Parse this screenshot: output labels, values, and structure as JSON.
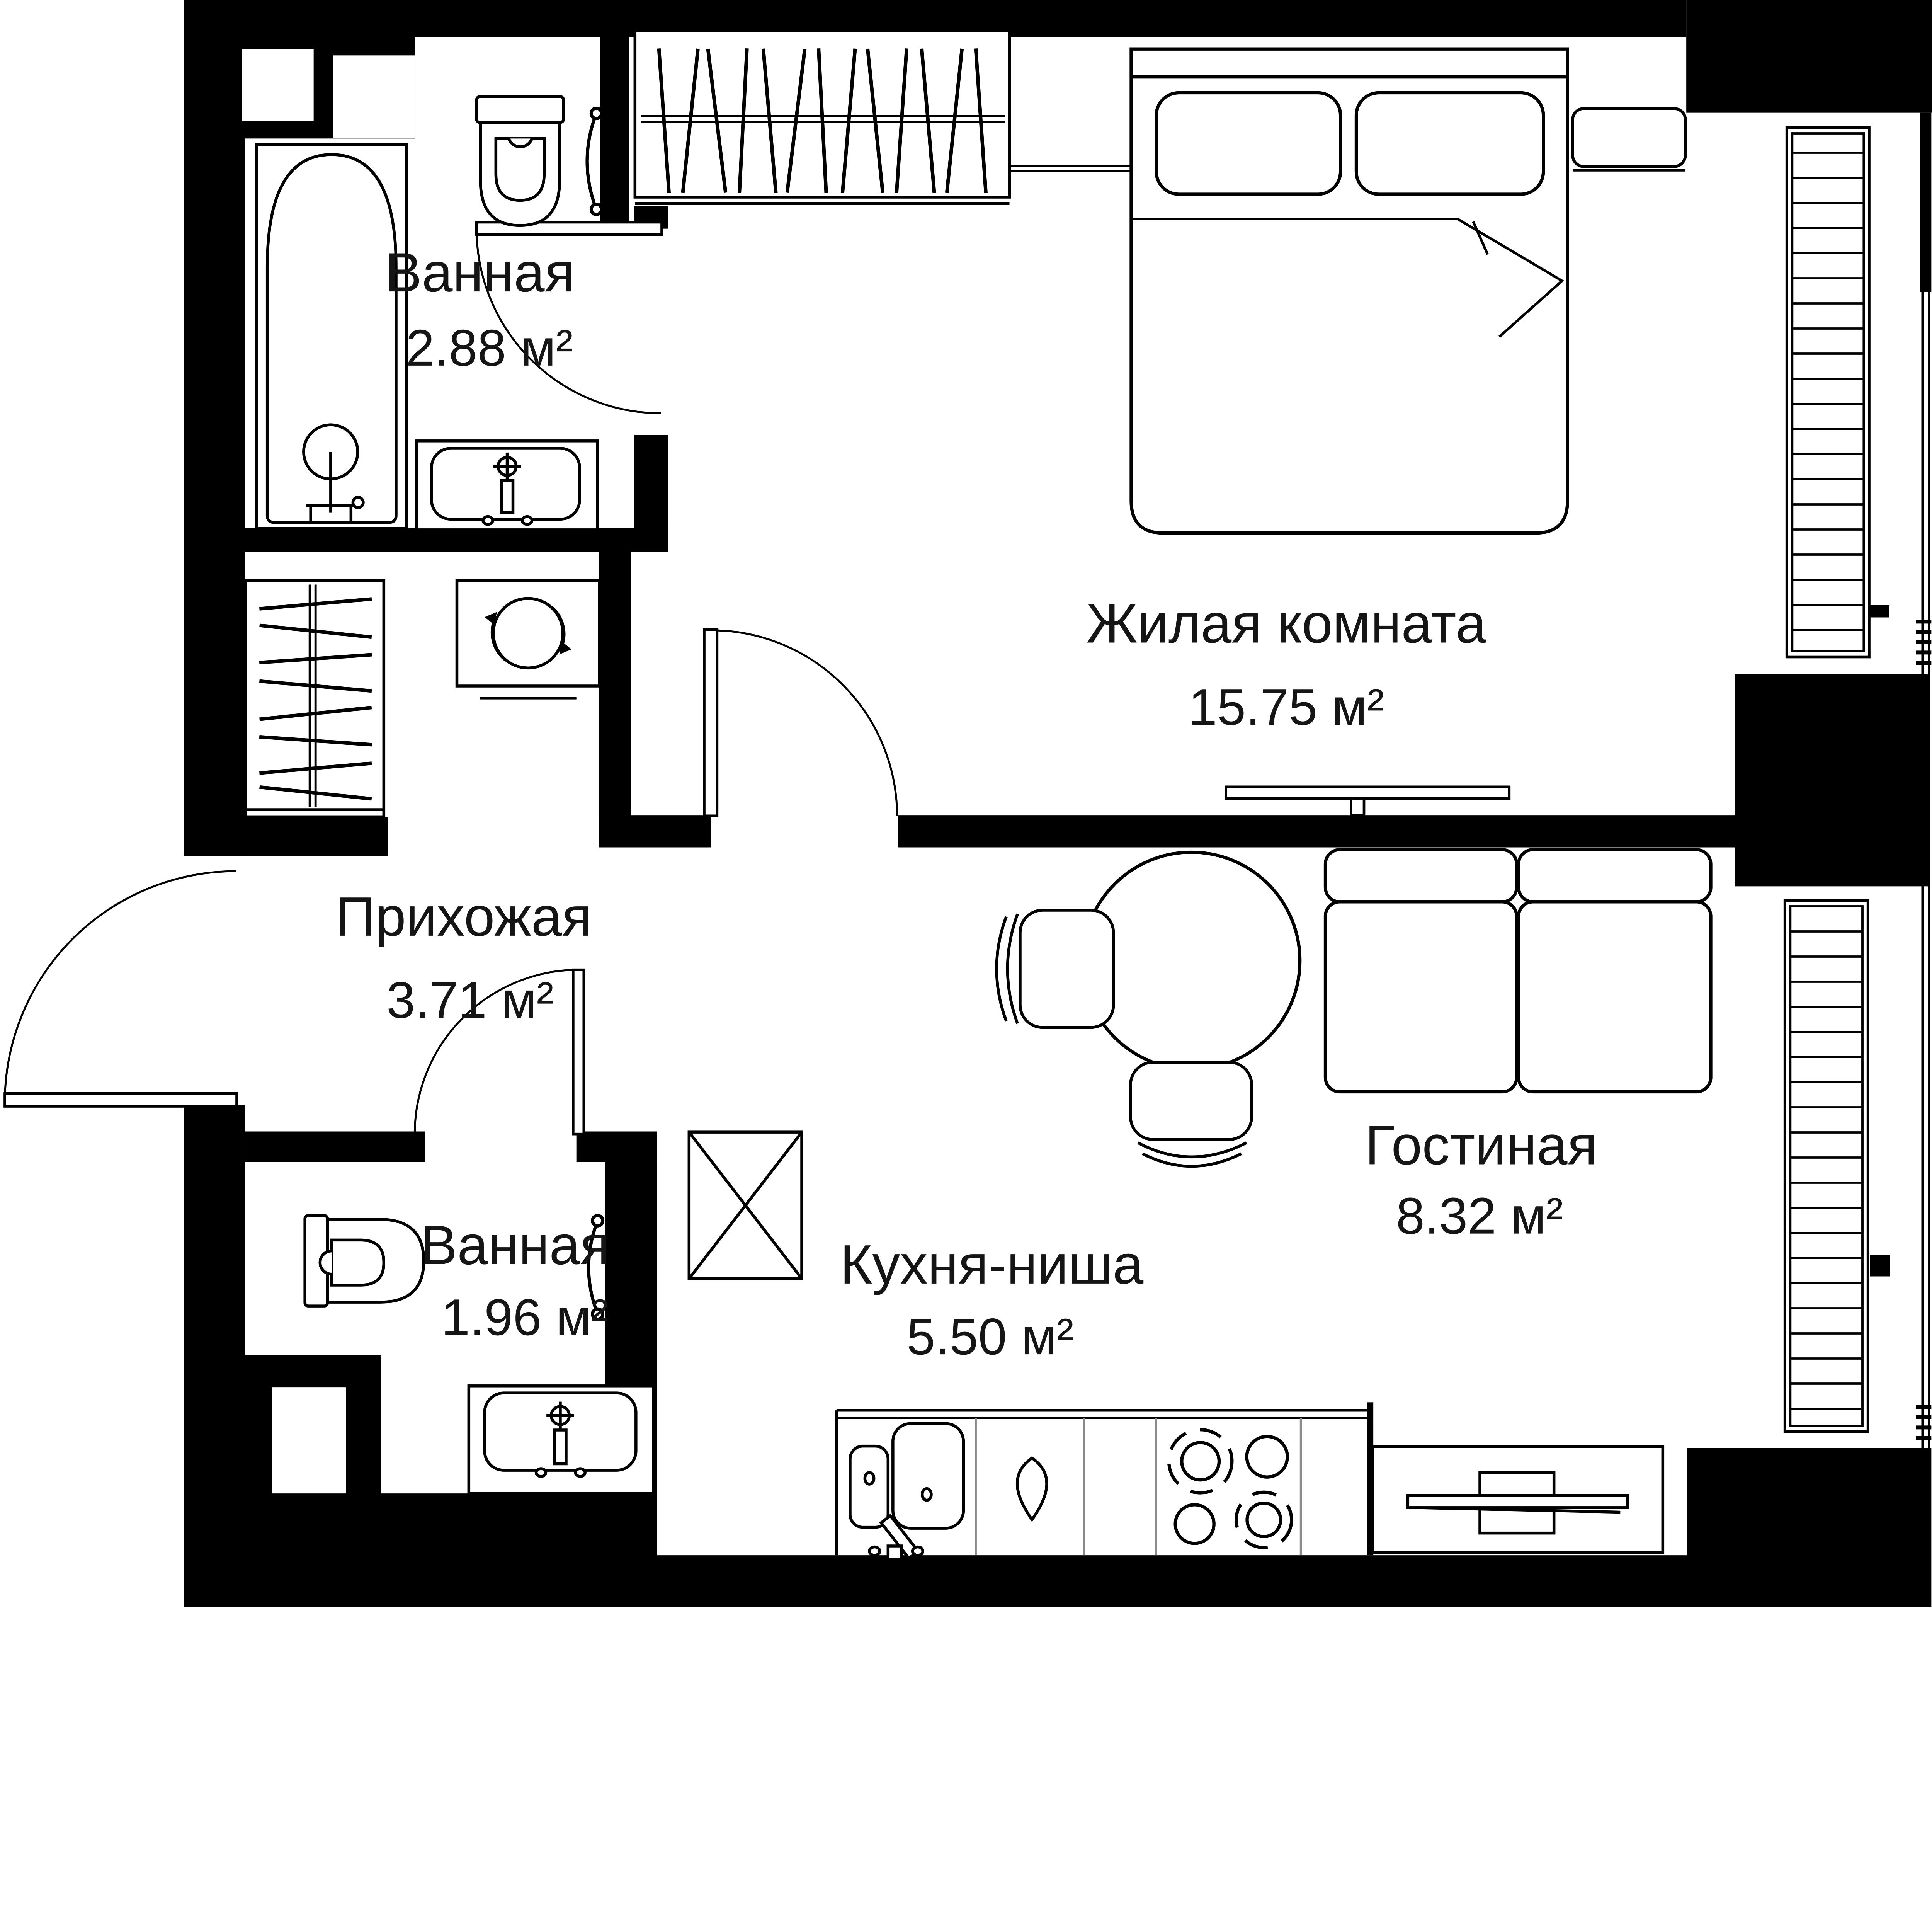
{
  "plan": {
    "type": "apartment-floor-plan",
    "style": "black-and-white architectural drawing",
    "area_unit": "м²"
  },
  "colors": {
    "walls": "#000000",
    "lines": "#000000",
    "counter_dividers": "#8a8a8a",
    "background": "#ffffff",
    "text": "#151515"
  },
  "rooms": [
    {
      "id": "bathroom-top",
      "name": "Ванная",
      "area": "2.88 м²"
    },
    {
      "id": "bedroom",
      "name": "Жилая комната",
      "area": "15.75 м²"
    },
    {
      "id": "hallway",
      "name": "Прихожая",
      "area": "3.71 м²"
    },
    {
      "id": "bathroom-low",
      "name": "Ванная",
      "area": "1.96 м²"
    },
    {
      "id": "kitchen-niche",
      "name": "Кухня-ниша",
      "area": "5.50 м²"
    },
    {
      "id": "lounge",
      "name": "Гостиная",
      "area": "8.32 м²"
    }
  ],
  "fixtures": [
    "bathtub",
    "toilet",
    "wall-sink",
    "towel-rail",
    "wardrobe-hangers",
    "hallway-closet-hangers",
    "washing-machine",
    "double-bed",
    "pillows",
    "nightstand",
    "wall-tv",
    "sofa-two-seat",
    "round-table",
    "chair",
    "refrigerator",
    "kitchen-counter",
    "kitchen-double-sink",
    "water-drop-symbol",
    "cooktop-4-burners",
    "tv-cabinet",
    "window-glazing-strip",
    "entrance-door",
    "interior-door"
  ]
}
